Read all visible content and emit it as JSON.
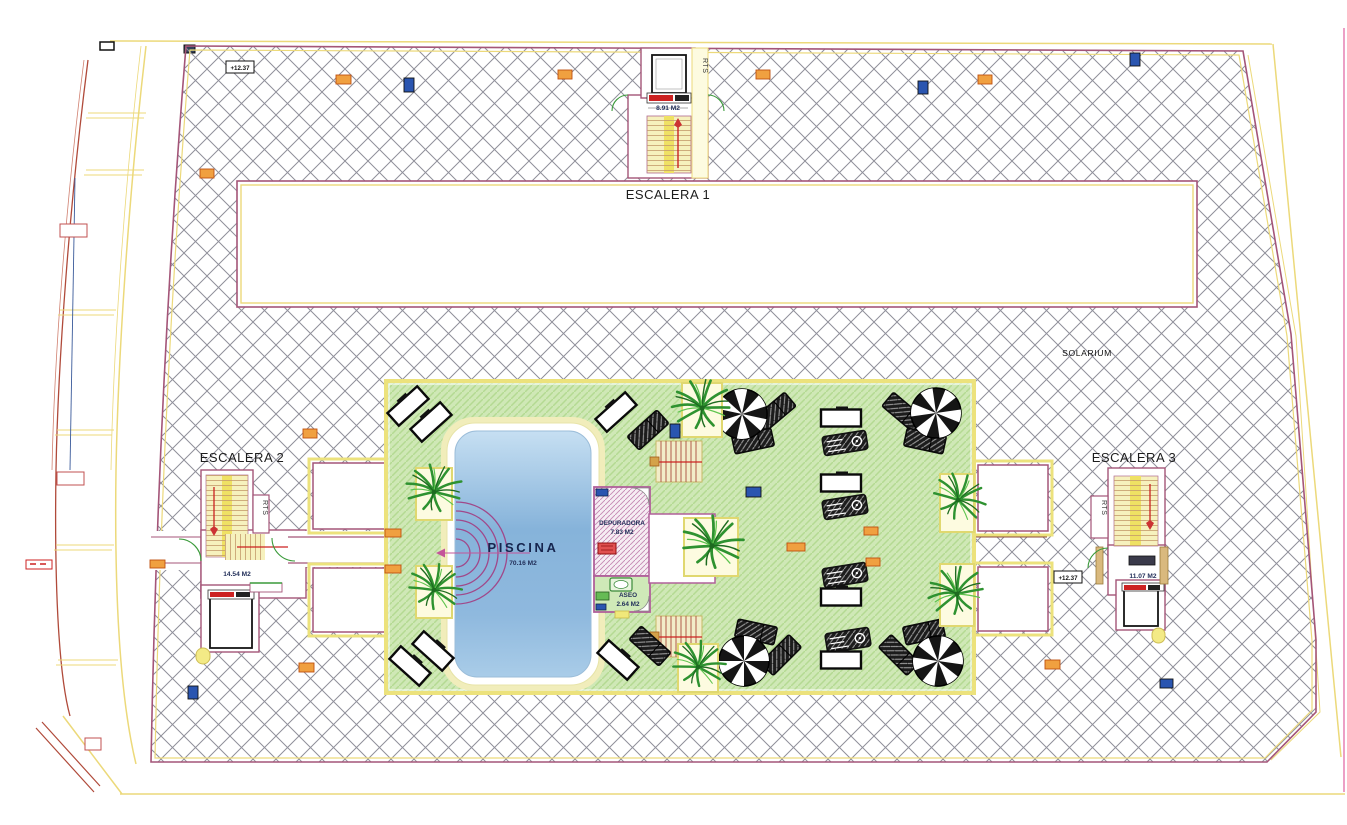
{
  "plan": {
    "solarium_label": "SOLARIUM",
    "escalera1": {
      "label": "ESCALERA 1",
      "area": "8.91 M2",
      "rts": "RTS"
    },
    "escalera2": {
      "label": "ESCALERA 2",
      "area": "14.54 M2",
      "rts": "RTS"
    },
    "escalera3": {
      "label": "ESCALERA 3",
      "area": "11.07 M2",
      "rts": "RTS"
    },
    "piscina": {
      "label": "PISCINA",
      "area": "70.16 M2"
    },
    "depuradora": {
      "label": "DEPURADORA",
      "area": "7.83 M2"
    },
    "aseo": {
      "label": "ASEO",
      "area": "2.64 M2"
    },
    "elevations": {
      "top_left": "+12.37",
      "right": "+12.37"
    },
    "colors": {
      "hatch_line": "#8f8f9a",
      "boundary_purple": "#a45578",
      "offset_yellow": "#ecd97a",
      "deck_green": "#cfe8b6",
      "deck_green_line": "#b4da92",
      "pool_blue": "#86b3da",
      "stair_yellow": "#f6f1bd",
      "accent_red": "#cc2222",
      "accent_orange": "#f0a040",
      "marker_blue": "#2a55b0",
      "text_navy": "#16254e"
    }
  }
}
